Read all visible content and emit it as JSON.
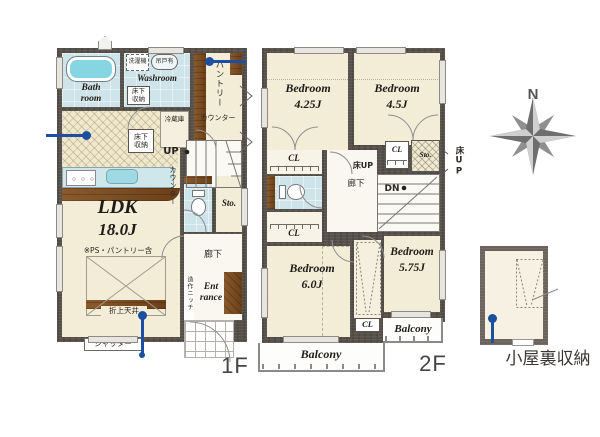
{
  "colors": {
    "wall": "#57514b",
    "floor_cream": "#f3ecd7",
    "wet_blue": "#cfe4ea",
    "tub_cyan": "#86d5e3",
    "wood_brown": "#7c4f27",
    "pin_blue": "#1c4f9f"
  },
  "floor1": {
    "floor_label": "1F",
    "bath_label": "Bath\nroom",
    "washroom_label": "Washroom",
    "washer_label": "洗濯機",
    "hanging_door_label": "吊戸有",
    "underfloor_storage_label": "床下\n収納",
    "pantry_label": "パントリー",
    "pantry_counter_label": "カウンター",
    "fridge_label": "冷蔵庫",
    "up_label": "UP",
    "stair_counter_label": "カウンター",
    "ldk_name": "LDK",
    "ldk_size": "18.0J",
    "ldk_note": "※PS・パントリー含",
    "storage_label": "Sto.",
    "hallway_label": "廊下",
    "entrance_label": "Ent\nrance",
    "niche_label": "造作ニッチ",
    "raised_ceiling_label": "折上天井",
    "shutter_label": "シャッター"
  },
  "floor2": {
    "floor_label": "2F",
    "bedrooms": [
      {
        "name": "Bedroom",
        "size": "4.25J"
      },
      {
        "name": "Bedroom",
        "size": "4.5J"
      },
      {
        "name": "Bedroom",
        "size": "6.0J"
      },
      {
        "name": "Bedroom",
        "size": "5.75J"
      }
    ],
    "closet_label": "CL",
    "storage_label": "Sto.",
    "floor_up_label": "床UP",
    "hallway_label": "廊下",
    "down_label": "DN",
    "balcony_label": "Balcony"
  },
  "compass": {
    "north_label": "N"
  },
  "attic": {
    "label": "小屋裏収納"
  }
}
